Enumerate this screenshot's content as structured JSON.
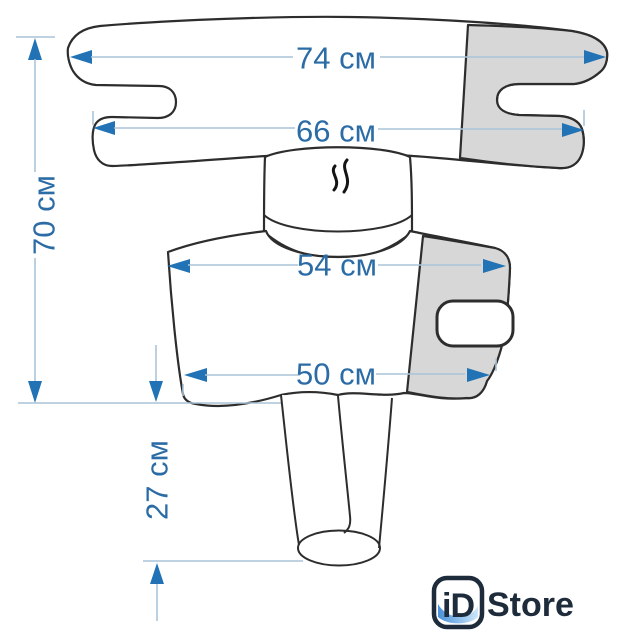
{
  "diagram": {
    "product": "massage-wrap-dimension-diagram",
    "labels": {
      "top_width": "74 см",
      "collar_width": "66 см",
      "total_height": "70 см",
      "upper_body_width": "54 см",
      "hem_width": "50 см",
      "sleeve_length": "27 см"
    },
    "icons": {
      "center_icon": "steam-icon"
    },
    "colors": {
      "dimension_text": "#2b6ca6",
      "arrow": "#2173b5",
      "dimension_line": "#aac4d8",
      "outline": "#2d2d2d",
      "shaded_fill": "#d7d7d7",
      "background": "#ffffff"
    }
  },
  "branding": {
    "logo_badge": "iD",
    "logo_text": "Store",
    "logo_color": "#1d2b3b",
    "logo_accent": "#4a90d9"
  }
}
